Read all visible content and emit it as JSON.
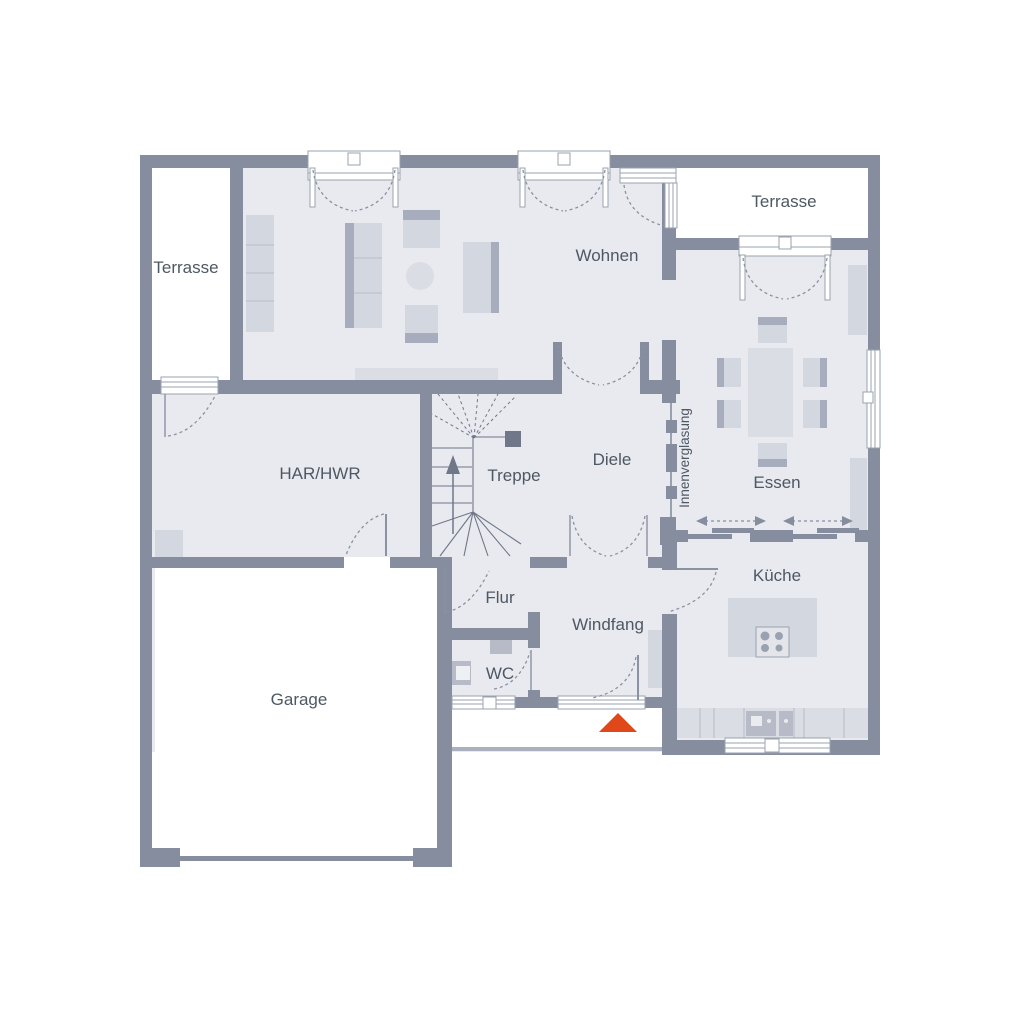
{
  "colors": {
    "wall": "#858D9F",
    "room": "#E8EAEF",
    "outdoor": "#FFFFFF",
    "furniture": "#D3D7E0",
    "furniture_light": "#DADDE3",
    "furniture_dark": "#A7ADBC",
    "appliance": "#B6BBC7",
    "text": "#4E5864",
    "accent": "#E0481A",
    "door_arc": "#8A92A3",
    "frame": "#9AA1AF",
    "stair": "#6F7788"
  },
  "rooms": [
    {
      "id": "terrasse-left",
      "label": "Terrasse"
    },
    {
      "id": "wohnen",
      "label": "Wohnen"
    },
    {
      "id": "terrasse-right",
      "label": "Terrasse"
    },
    {
      "id": "essen",
      "label": "Essen"
    },
    {
      "id": "har-hwr",
      "label": "HAR/HWR"
    },
    {
      "id": "treppe",
      "label": "Treppe"
    },
    {
      "id": "diele",
      "label": "Diele"
    },
    {
      "id": "flur",
      "label": "Flur"
    },
    {
      "id": "windfang",
      "label": "Windfang"
    },
    {
      "id": "wc",
      "label": "WC"
    },
    {
      "id": "kueche",
      "label": "Küche"
    },
    {
      "id": "garage",
      "label": "Garage"
    }
  ],
  "annotations": [
    {
      "id": "innenverglasung",
      "label": "Innenverglasung"
    }
  ],
  "markers": [
    {
      "id": "entrance-arrow",
      "meaning": "entrance-direction",
      "color": "#E0481A"
    }
  ]
}
